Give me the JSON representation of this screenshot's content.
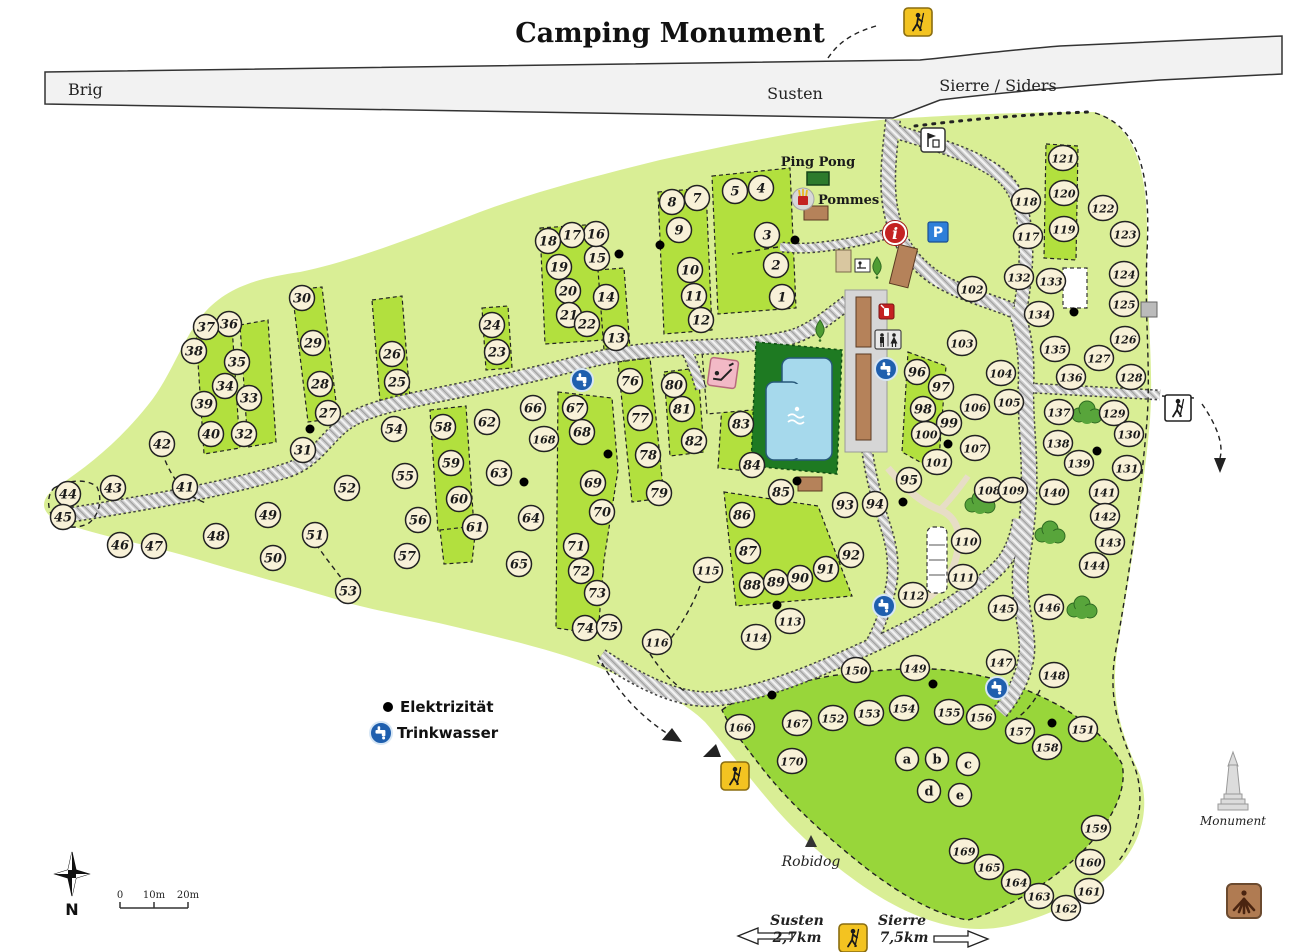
{
  "title": "Camping Monument",
  "highway": {
    "left_label": "Brig",
    "center_label": "Susten",
    "right_label": "Sierre / Siders"
  },
  "signs": {
    "parking": "P",
    "info": "i",
    "north": "N"
  },
  "amenities": {
    "ping_pong": "Ping Pong",
    "pommes": "Pommes",
    "robidog": "Robidog",
    "monument": "Monument"
  },
  "legend": {
    "electricity": "Elektrizität",
    "water": "Trinkwasser"
  },
  "scale": {
    "t0": "0",
    "t1": "10m",
    "t2": "20m"
  },
  "directions": {
    "susten": {
      "name": "Susten",
      "distance": "2,7km"
    },
    "sierre": {
      "name": "Sierre",
      "distance": "7,5km"
    }
  },
  "colors": {
    "land": "#d9ee95",
    "pitch": "#b2e03e",
    "group_area": "#98d63a",
    "pool_green": "#1e7a22",
    "pool_blue": "#a6d9ec",
    "highway": "#f2f2f2",
    "marker_fill": "#f8f1d8",
    "parking_blue": "#2e7fd9",
    "info_red": "#c42222",
    "water_blue": "#1f5fae",
    "hiker_yellow": "#f3c321"
  },
  "map": {
    "sites": [
      [
        "1",
        782,
        297
      ],
      [
        "2",
        776,
        265
      ],
      [
        "3",
        767,
        235
      ],
      [
        "4",
        761,
        188
      ],
      [
        "5",
        735,
        191
      ],
      [
        "7",
        697,
        198
      ],
      [
        "8",
        672,
        202
      ],
      [
        "9",
        679,
        230
      ],
      [
        "10",
        690,
        270
      ],
      [
        "11",
        694,
        296
      ],
      [
        "12",
        701,
        320
      ],
      [
        "13",
        616,
        338
      ],
      [
        "14",
        606,
        297
      ],
      [
        "15",
        597,
        258
      ],
      [
        "16",
        596,
        234
      ],
      [
        "17",
        572,
        235
      ],
      [
        "18",
        548,
        241
      ],
      [
        "19",
        559,
        267
      ],
      [
        "20",
        568,
        291
      ],
      [
        "21",
        569,
        315
      ],
      [
        "22",
        587,
        324
      ],
      [
        "23",
        497,
        352
      ],
      [
        "24",
        492,
        325
      ],
      [
        "25",
        397,
        382
      ],
      [
        "26",
        392,
        354
      ],
      [
        "27",
        328,
        413
      ],
      [
        "28",
        320,
        384
      ],
      [
        "29",
        313,
        343
      ],
      [
        "30",
        302,
        298
      ],
      [
        "31",
        303,
        450
      ],
      [
        "32",
        244,
        434
      ],
      [
        "33",
        249,
        398
      ],
      [
        "34",
        225,
        386
      ],
      [
        "35",
        237,
        362
      ],
      [
        "36",
        229,
        324
      ],
      [
        "37",
        206,
        327
      ],
      [
        "38",
        194,
        351
      ],
      [
        "39",
        204,
        404
      ],
      [
        "40",
        211,
        434
      ],
      [
        "41",
        185,
        487
      ],
      [
        "42",
        162,
        444
      ],
      [
        "43",
        113,
        488
      ],
      [
        "44",
        68,
        494
      ],
      [
        "45",
        63,
        517
      ],
      [
        "46",
        120,
        545
      ],
      [
        "47",
        154,
        546
      ],
      [
        "48",
        216,
        536
      ],
      [
        "49",
        268,
        515
      ],
      [
        "50",
        273,
        558
      ],
      [
        "51",
        315,
        535
      ],
      [
        "52",
        347,
        488
      ],
      [
        "53",
        348,
        591
      ],
      [
        "54",
        394,
        429
      ],
      [
        "55",
        405,
        476
      ],
      [
        "56",
        418,
        520
      ],
      [
        "57",
        407,
        556
      ],
      [
        "58",
        443,
        427
      ],
      [
        "59",
        451,
        463
      ],
      [
        "60",
        459,
        499
      ],
      [
        "61",
        475,
        527
      ],
      [
        "62",
        487,
        422
      ],
      [
        "63",
        499,
        473
      ],
      [
        "64",
        531,
        518
      ],
      [
        "65",
        519,
        564
      ],
      [
        "66",
        533,
        408
      ],
      [
        "67",
        575,
        408
      ],
      [
        "68",
        582,
        432
      ],
      [
        "69",
        593,
        483
      ],
      [
        "70",
        602,
        512
      ],
      [
        "71",
        576,
        546
      ],
      [
        "72",
        581,
        571
      ],
      [
        "73",
        597,
        593
      ],
      [
        "74",
        585,
        628
      ],
      [
        "75",
        609,
        627
      ],
      [
        "76",
        630,
        381
      ],
      [
        "77",
        640,
        418
      ],
      [
        "78",
        648,
        455
      ],
      [
        "79",
        659,
        493
      ],
      [
        "80",
        674,
        385
      ],
      [
        "81",
        682,
        409
      ],
      [
        "82",
        694,
        441
      ],
      [
        "83",
        741,
        424
      ],
      [
        "84",
        752,
        465
      ],
      [
        "85",
        781,
        492
      ],
      [
        "86",
        742,
        515
      ],
      [
        "87",
        748,
        551
      ],
      [
        "88",
        752,
        585
      ],
      [
        "89",
        776,
        582
      ],
      [
        "90",
        800,
        578
      ],
      [
        "91",
        826,
        569
      ],
      [
        "92",
        851,
        555
      ],
      [
        "93",
        845,
        505
      ],
      [
        "94",
        875,
        504
      ],
      [
        "95",
        909,
        480
      ],
      [
        "96",
        917,
        372
      ],
      [
        "97",
        941,
        387
      ],
      [
        "98",
        923,
        409
      ],
      [
        "99",
        949,
        423
      ],
      [
        "100",
        926,
        434
      ],
      [
        "101",
        937,
        462
      ],
      [
        "102",
        972,
        289
      ],
      [
        "103",
        962,
        343
      ],
      [
        "104",
        1001,
        373
      ],
      [
        "105",
        1009,
        402
      ],
      [
        "106",
        975,
        407
      ],
      [
        "107",
        975,
        448
      ],
      [
        "108",
        989,
        490
      ],
      [
        "109",
        1013,
        490
      ],
      [
        "110",
        966,
        541
      ],
      [
        "111",
        963,
        577
      ],
      [
        "112",
        913,
        595
      ],
      [
        "113",
        790,
        621
      ],
      [
        "114",
        756,
        637
      ],
      [
        "115",
        708,
        570
      ],
      [
        "116",
        657,
        642
      ],
      [
        "117",
        1028,
        236
      ],
      [
        "118",
        1026,
        201
      ],
      [
        "119",
        1064,
        229
      ],
      [
        "120",
        1064,
        193
      ],
      [
        "121",
        1063,
        158
      ],
      [
        "122",
        1103,
        208
      ],
      [
        "123",
        1125,
        234
      ],
      [
        "124",
        1124,
        274
      ],
      [
        "125",
        1124,
        304
      ],
      [
        "126",
        1125,
        339
      ],
      [
        "127",
        1099,
        358
      ],
      [
        "128",
        1131,
        377
      ],
      [
        "129",
        1114,
        413
      ],
      [
        "130",
        1129,
        434
      ],
      [
        "131",
        1127,
        468
      ],
      [
        "132",
        1019,
        277
      ],
      [
        "133",
        1051,
        281
      ],
      [
        "134",
        1039,
        314
      ],
      [
        "135",
        1055,
        349
      ],
      [
        "136",
        1071,
        377
      ],
      [
        "137",
        1059,
        412
      ],
      [
        "138",
        1058,
        443
      ],
      [
        "139",
        1079,
        463
      ],
      [
        "140",
        1054,
        492
      ],
      [
        "141",
        1104,
        492
      ],
      [
        "142",
        1105,
        516
      ],
      [
        "143",
        1110,
        542
      ],
      [
        "144",
        1094,
        565
      ],
      [
        "145",
        1003,
        608
      ],
      [
        "146",
        1049,
        607
      ],
      [
        "147",
        1001,
        662
      ],
      [
        "148",
        1054,
        675
      ],
      [
        "149",
        915,
        668
      ],
      [
        "150",
        856,
        670
      ],
      [
        "151",
        1083,
        729
      ],
      [
        "152",
        833,
        718
      ],
      [
        "153",
        869,
        713
      ],
      [
        "154",
        904,
        708
      ],
      [
        "155",
        949,
        712
      ],
      [
        "156",
        981,
        717
      ],
      [
        "157",
        1020,
        731
      ],
      [
        "158",
        1047,
        747
      ],
      [
        "159",
        1096,
        828
      ],
      [
        "160",
        1090,
        862
      ],
      [
        "161",
        1089,
        891
      ],
      [
        "162",
        1066,
        908
      ],
      [
        "163",
        1039,
        896
      ],
      [
        "164",
        1016,
        882
      ],
      [
        "165",
        989,
        867
      ],
      [
        "166",
        740,
        727
      ],
      [
        "167",
        797,
        723
      ],
      [
        "168",
        544,
        439
      ],
      [
        "169",
        964,
        851
      ],
      [
        "170",
        792,
        761
      ],
      [
        "a",
        907,
        759
      ],
      [
        "b",
        937,
        759
      ],
      [
        "c",
        968,
        764
      ],
      [
        "d",
        929,
        791
      ],
      [
        "e",
        960,
        795
      ]
    ],
    "electricity_dots": [
      [
        310,
        429
      ],
      [
        619,
        254
      ],
      [
        660,
        245
      ],
      [
        795,
        240
      ],
      [
        524,
        482
      ],
      [
        608,
        454
      ],
      [
        797,
        481
      ],
      [
        777,
        605
      ],
      [
        772,
        695
      ],
      [
        933,
        684
      ],
      [
        1052,
        723
      ],
      [
        1074,
        312
      ],
      [
        1097,
        451
      ],
      [
        948,
        444
      ],
      [
        903,
        502
      ]
    ],
    "water_taps": [
      [
        582,
        380
      ],
      [
        886,
        369
      ],
      [
        884,
        606
      ],
      [
        997,
        688
      ]
    ],
    "hiker_signs_yellow": [
      [
        918,
        22
      ],
      [
        735,
        776
      ],
      [
        853,
        938
      ]
    ],
    "hiker_signs_white": [
      [
        1178,
        408
      ]
    ]
  }
}
